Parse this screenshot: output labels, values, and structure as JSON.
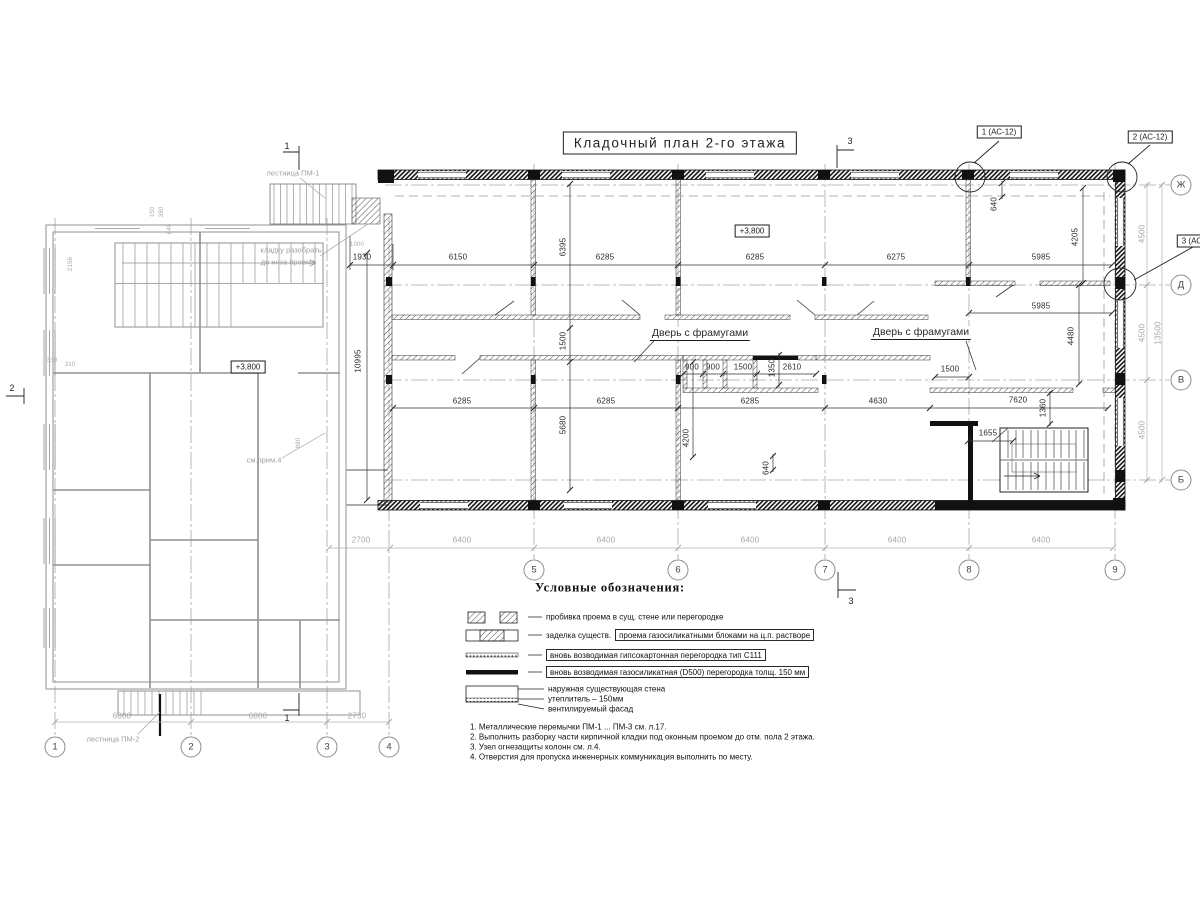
{
  "title": "Кладочный план 2-го этажа",
  "callouts": [
    {
      "t": "1 (АС-12)",
      "x": 999,
      "y": 132
    },
    {
      "t": "2 (АС-12)",
      "x": 1150,
      "y": 137
    },
    {
      "t": "3 (АС-12)",
      "x": 1199,
      "y": 241
    }
  ],
  "levels": [
    {
      "t": "+3,800",
      "x": 752,
      "y": 231
    },
    {
      "t": "+3,800",
      "x": 248,
      "y": 367
    }
  ],
  "door_labels": [
    {
      "t": "Дверь с фрамугами",
      "x": 700,
      "y": 334
    },
    {
      "t": "Дверь с фрамугами",
      "x": 921,
      "y": 333
    }
  ],
  "annotations": [
    {
      "t": "лестница ПМ-1",
      "x": 293,
      "y": 173
    },
    {
      "t": "кладку разобрать",
      "x": 291,
      "y": 250
    },
    {
      "t": "до низа проема",
      "x": 288,
      "y": 262
    },
    {
      "t": "см.прим.4",
      "x": 264,
      "y": 460
    },
    {
      "t": "лестница ПМ-2",
      "x": 113,
      "y": 739
    }
  ],
  "section_marks": [
    {
      "l": "1",
      "x": 287,
      "y": 146
    },
    {
      "l": "1",
      "x": 287,
      "y": 718
    },
    {
      "l": "3",
      "x": 850,
      "y": 141
    },
    {
      "l": "3",
      "x": 851,
      "y": 601
    },
    {
      "l": "2",
      "x": 12,
      "y": 388
    }
  ],
  "axes": {
    "right": [
      {
        "l": "Ж",
        "x": 1181,
        "y": 185
      },
      {
        "l": "Д",
        "x": 1181,
        "y": 285
      },
      {
        "l": "В",
        "x": 1181,
        "y": 380
      },
      {
        "l": "Б",
        "x": 1181,
        "y": 480
      }
    ],
    "bottom_main": [
      {
        "l": "5",
        "x": 534,
        "y": 570
      },
      {
        "l": "6",
        "x": 678,
        "y": 570
      },
      {
        "l": "7",
        "x": 825,
        "y": 570
      },
      {
        "l": "8",
        "x": 969,
        "y": 570
      },
      {
        "l": "9",
        "x": 1115,
        "y": 570
      }
    ],
    "bottom_left": [
      {
        "l": "1",
        "x": 55,
        "y": 747
      },
      {
        "l": "2",
        "x": 191,
        "y": 747
      },
      {
        "l": "3",
        "x": 327,
        "y": 747
      },
      {
        "l": "4",
        "x": 389,
        "y": 747
      }
    ]
  },
  "dims": [
    {
      "v": "1930",
      "x": 362,
      "y": 257
    },
    {
      "v": "6150",
      "x": 458,
      "y": 257
    },
    {
      "v": "6285",
      "x": 605,
      "y": 257
    },
    {
      "v": "6285",
      "x": 755,
      "y": 257
    },
    {
      "v": "6275",
      "x": 896,
      "y": 257
    },
    {
      "v": "5985",
      "x": 1041,
      "y": 257
    },
    {
      "v": "5985",
      "x": 1041,
      "y": 306
    },
    {
      "v": "900",
      "x": 692,
      "y": 367
    },
    {
      "v": "900",
      "x": 713,
      "y": 367
    },
    {
      "v": "1500",
      "x": 743,
      "y": 367
    },
    {
      "v": "2610",
      "x": 792,
      "y": 367
    },
    {
      "v": "1500",
      "x": 950,
      "y": 369
    },
    {
      "v": "6285",
      "x": 462,
      "y": 401
    },
    {
      "v": "6285",
      "x": 606,
      "y": 401
    },
    {
      "v": "6285",
      "x": 750,
      "y": 401
    },
    {
      "v": "4630",
      "x": 878,
      "y": 401
    },
    {
      "v": "7620",
      "x": 1018,
      "y": 400
    },
    {
      "v": "1655",
      "x": 988,
      "y": 433
    },
    {
      "v": "6395",
      "x": 563,
      "y": 247,
      "rot": 1
    },
    {
      "v": "1500",
      "x": 563,
      "y": 341,
      "rot": 1
    },
    {
      "v": "5680",
      "x": 563,
      "y": 425,
      "rot": 1
    },
    {
      "v": "10995",
      "x": 358,
      "y": 361,
      "rot": 1
    },
    {
      "v": "640",
      "x": 994,
      "y": 204,
      "rot": 1
    },
    {
      "v": "4205",
      "x": 1075,
      "y": 237,
      "rot": 1
    },
    {
      "v": "4480",
      "x": 1071,
      "y": 336,
      "rot": 1
    },
    {
      "v": "4200",
      "x": 686,
      "y": 438,
      "rot": 1
    },
    {
      "v": "640",
      "x": 766,
      "y": 468,
      "rot": 1
    },
    {
      "v": "1350",
      "x": 772,
      "y": 368,
      "rot": 1
    },
    {
      "v": "1360",
      "x": 1043,
      "y": 408,
      "rot": 1
    },
    {
      "v": "4500",
      "x": 1142,
      "y": 234,
      "rot": 1,
      "g": 1
    },
    {
      "v": "4500",
      "x": 1142,
      "y": 333,
      "rot": 1,
      "g": 1
    },
    {
      "v": "4500",
      "x": 1142,
      "y": 430,
      "rot": 1,
      "g": 1
    },
    {
      "v": "13500",
      "x": 1158,
      "y": 333,
      "rot": 1,
      "g": 1
    },
    {
      "v": "2700",
      "x": 361,
      "y": 540,
      "g": 1
    },
    {
      "v": "6400",
      "x": 462,
      "y": 540,
      "g": 1
    },
    {
      "v": "6400",
      "x": 606,
      "y": 540,
      "g": 1
    },
    {
      "v": "6400",
      "x": 750,
      "y": 540,
      "g": 1
    },
    {
      "v": "6400",
      "x": 897,
      "y": 540,
      "g": 1
    },
    {
      "v": "6400",
      "x": 1041,
      "y": 540,
      "g": 1
    },
    {
      "v": "6000",
      "x": 122,
      "y": 716,
      "g": 1
    },
    {
      "v": "6000",
      "x": 258,
      "y": 716,
      "g": 1
    },
    {
      "v": "2730",
      "x": 357,
      "y": 716,
      "g": 1
    },
    {
      "v": "2156",
      "x": 71,
      "y": 264,
      "rot": 1,
      "g": 1,
      "sm": 1
    },
    {
      "v": "880",
      "x": 299,
      "y": 443,
      "rot": 1,
      "g": 1,
      "sm": 1
    },
    {
      "v": "330",
      "x": 52,
      "y": 361,
      "g": 1,
      "sm": 1
    },
    {
      "v": "310",
      "x": 70,
      "y": 365,
      "g": 1,
      "sm": 1
    },
    {
      "v": "150",
      "x": 153,
      "y": 212,
      "rot": 1,
      "g": 1,
      "sm": 1
    },
    {
      "v": "380",
      "x": 162,
      "y": 212,
      "rot": 1,
      "g": 1,
      "sm": 1
    },
    {
      "v": "640",
      "x": 170,
      "y": 229,
      "rot": 1,
      "g": 1,
      "sm": 1
    },
    {
      "v": "1000",
      "x": 357,
      "y": 245,
      "g": 1,
      "sm": 1
    }
  ],
  "legend": {
    "title": "Условные обозначения:",
    "items": [
      {
        "text": "пробивка проема  в сущ. стене  или перегородке"
      },
      {
        "text": "заделка существ.",
        "boxed": "проема газосиликатными блоками на ц.п. растворе"
      },
      {
        "boxed": "вновь возводимая гипсокартонная перегородка тип С111"
      },
      {
        "boxed": "вновь возводимая газосиликатная (D500) перегородка толщ. 150 мм"
      },
      {
        "lines": [
          "наружная существующая стена",
          "утеплитель – 150мм",
          "вентилируемый фасад"
        ]
      }
    ]
  },
  "notes": [
    "1. Металлические перемычки  ПМ-1 ... ПМ-3  см. л.17.",
    "2. Выполнить разборку части кирпичной кладки под оконным проемом до отм. пола 2 этажа.",
    "3. Узел огнезащиты колонн см. л.4.",
    "4. Отверстия для пропуска инженерных коммуникация выполнить по месту."
  ]
}
